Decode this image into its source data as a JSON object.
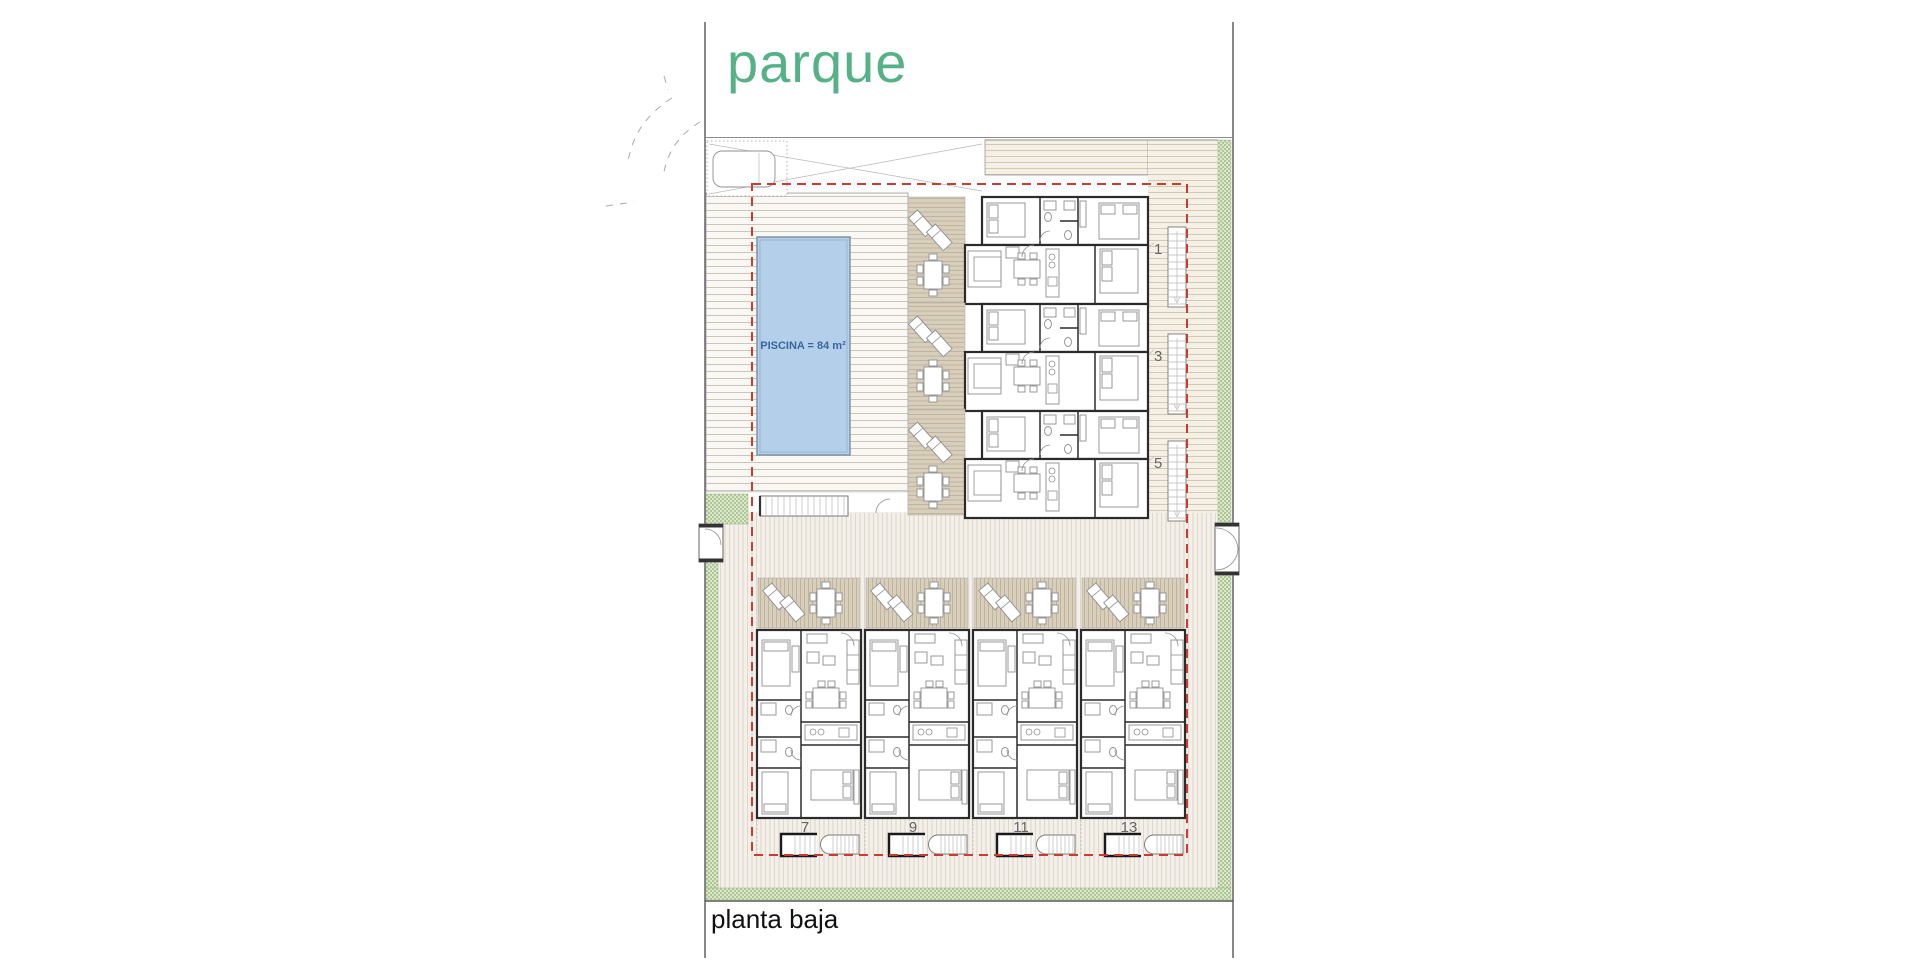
{
  "site": {
    "park_label": "parque",
    "floor_label": "planta baja",
    "pool_label": "PISCINA = 84 m²"
  },
  "units": {
    "upper_row_numbers": [
      "1",
      "3",
      "5"
    ],
    "lower_row_numbers": [
      "7",
      "9",
      "11",
      "13"
    ]
  },
  "colors": {
    "park_text": "#56b286",
    "floor_text": "#111111",
    "pool_fill": "#b4cfe9",
    "pool_text": "#3a66a0",
    "boundary_dash_red": "#cc3b2f",
    "wall": "#2b2b2b",
    "deck_line": "#cdc5b6",
    "terrace_fill": "#d8cebc",
    "terrace_line": "#bcae95",
    "paving_line": "#dcd0c4",
    "green_hatch": "#aec794",
    "unit_number": "#666666"
  }
}
